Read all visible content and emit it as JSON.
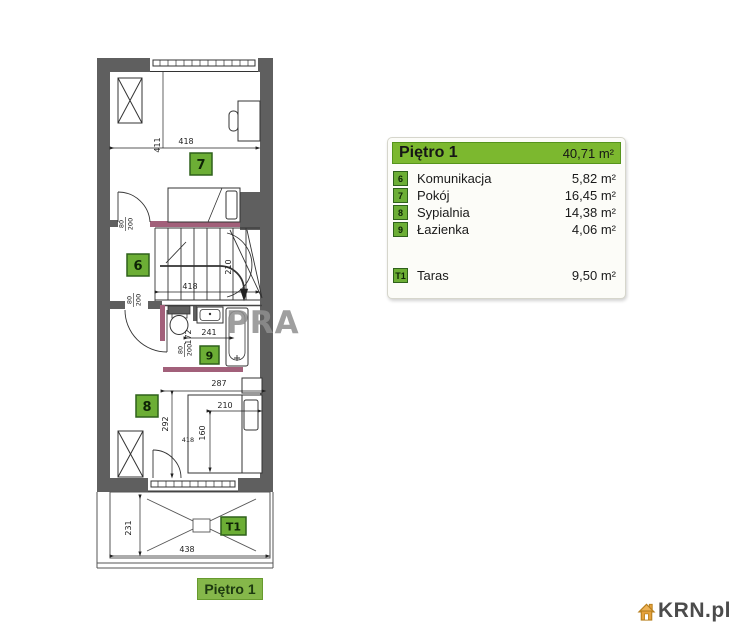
{
  "legend": {
    "title": "Piętro 1",
    "total_area": "40,71 m²",
    "rooms": [
      {
        "id": "6",
        "name": "Komunikacja",
        "area": "5,82 m²"
      },
      {
        "id": "7",
        "name": "Pokój",
        "area": "16,45 m²"
      },
      {
        "id": "8",
        "name": "Sypialnia",
        "area": "14,38 m²"
      },
      {
        "id": "9",
        "name": "Łazienka",
        "area": "4,06 m²"
      }
    ],
    "terrace": {
      "id": "T1",
      "name": "Taras",
      "area": "9,50 m²"
    }
  },
  "plan": {
    "floor_label": "Piętro 1",
    "watermark": "PRA",
    "dims": {
      "room7_width": "418",
      "room7_height": "411",
      "stairs_width": "210",
      "stairs_length": "418",
      "door_w": "80",
      "door_h": "200",
      "bath_width": "241",
      "bath_depth": "172",
      "room8_width": "287",
      "bed_length": "210",
      "bed_width": "160",
      "room8_mid": "418",
      "room8_height": "292",
      "terrace_depth": "231",
      "terrace_width": "438"
    }
  },
  "branding": {
    "logo_text": "KRN.pl"
  },
  "colors": {
    "header_green": "#7cb82f",
    "badge_green": "#6cae35",
    "wall_gray": "#5f5f5f",
    "accent_mauve": "#a2607a",
    "logo_orange": "#e6a23c"
  }
}
